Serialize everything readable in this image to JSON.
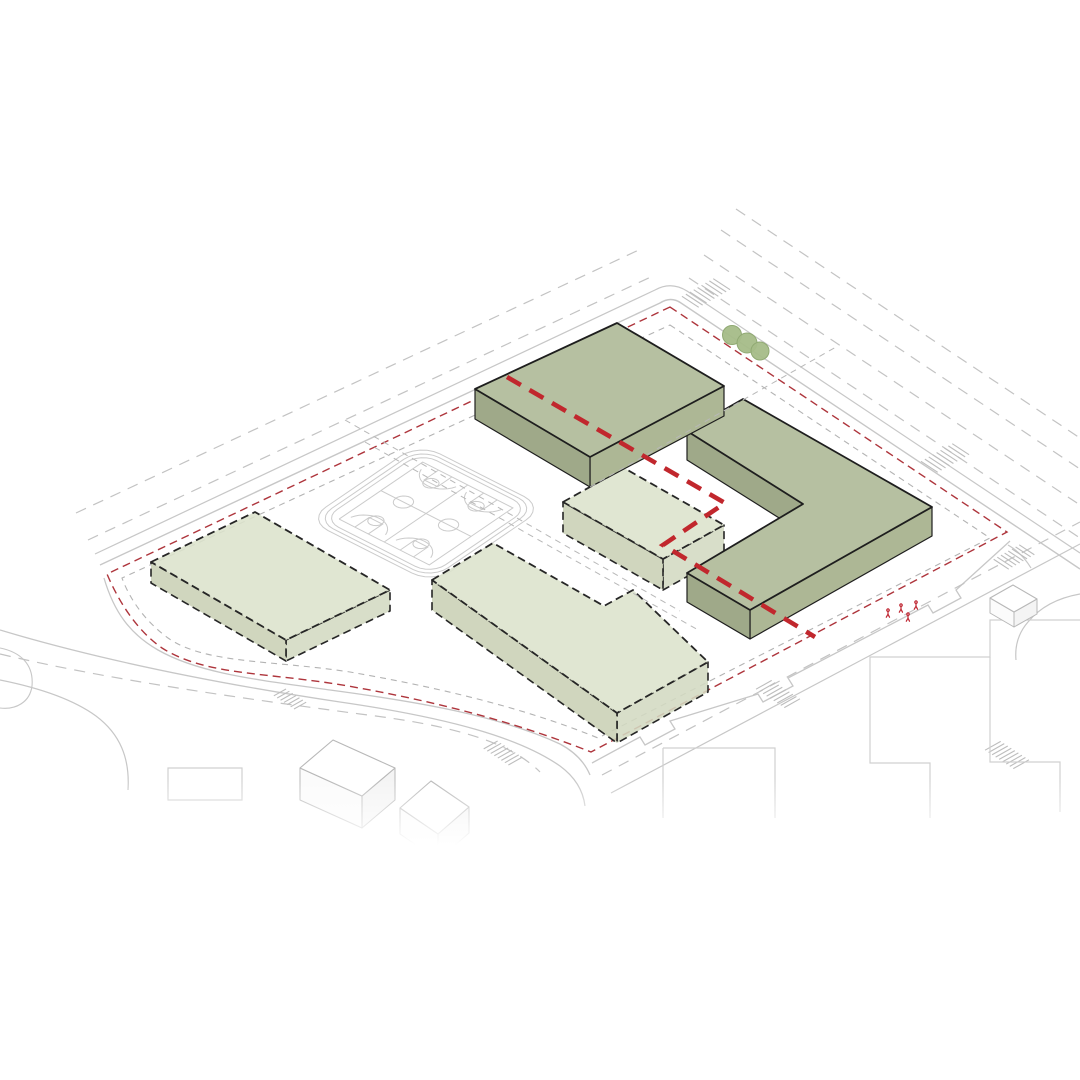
{
  "meta": {
    "description": "Axonometric architectural site massing diagram with proposed green building volumes, dashed massing slabs, running track with basketball courts, red dashed site boundary and thick red dashed pedestrian route",
    "background": "#ffffff"
  },
  "palette": {
    "dark_top": "#b6c0a1",
    "dark_sw": "#9fa989",
    "dark_se": "#adb795",
    "dark_stroke": "#1e1e1e",
    "light_top": "#dce2cc",
    "light_sw": "#c9d0b5",
    "light_se": "#d3d9c1",
    "light_stroke": "#262626",
    "curb": "#c7c7c7",
    "lane": "#c3c3c3",
    "inset": "#b3b3b3",
    "cross": "#b8b8b8",
    "red_boundary": "#ae353c",
    "red_route": "#c1272d",
    "court": "#cbcbcb",
    "crosswalk": "#bdbdbd",
    "tree_fill": "#a5bc88",
    "tree_stroke": "#90a973",
    "box_stroke": "#b8b8b8",
    "footprint": "#d0d0d0",
    "person": "#bf2430"
  },
  "roads": {
    "solid": [
      {
        "d": "M100,565 L660,303 Q671,296 681,303 L1080,569",
        "w": 1.4
      },
      {
        "d": "M95,554 L655,290 Q671,281 687,291 L1080,553",
        "w": 1.2
      },
      {
        "d": "M592,763 L640,737 l5,8 l30,-16 l-5,-8 L758,694 l5,8 l30,-16 l-5,-8 L928,605 l5,8 l28,-15 l-5,-8 L1010,541",
        "w": 1.3
      },
      {
        "d": "M611,793 L1080,544",
        "w": 1.2
      },
      {
        "d": "M104,578 C114,612 130,634 158,650 C200,674 260,680 330,690 C420,702 500,716 560,744 C575,752 585,763 590,775",
        "w": 1.3
      },
      {
        "d": "M0,630 C100,660 220,684 340,702 C450,718 520,738 560,766 C575,777 583,790 585,806",
        "w": 1.3
      },
      {
        "d": "M0,680 C40,688 74,700 96,716 C120,734 130,758 128,790",
        "w": 1.2
      },
      {
        "d": "M0,648 C20,652 34,664 32,686 C30,702 16,710 0,708",
        "w": 1.1
      },
      {
        "d": "M1008,545 Q1022,553 1031,568",
        "w": 1.2
      },
      {
        "d": "M1080,594 Q1046,600 1028,622 Q1014,638 1016,660",
        "w": 1.2
      }
    ],
    "dashed": [
      {
        "d": "M88,540 L655,275",
        "dash": "11 8"
      },
      {
        "d": "M76,513 L643,248",
        "dash": "11 8"
      },
      {
        "d": "M689,278 L1080,538",
        "dash": "11 8"
      },
      {
        "d": "M704,255 L1080,505",
        "dash": "11 8"
      },
      {
        "d": "M721,230 L1080,469",
        "dash": "11 8"
      },
      {
        "d": "M736,209 L1080,438",
        "dash": "11 8"
      },
      {
        "d": "M602,775 L1080,522",
        "dash": "11 8"
      },
      {
        "d": "M0,654 C110,680 240,698 360,714 C460,726 512,744 540,772",
        "dash": "11 8"
      }
    ],
    "crosswalks": [
      {
        "c": [
          706,
          293
        ],
        "along": [
          0.87,
          -0.49
        ],
        "tilt": [
          0.84,
          0.55
        ],
        "n": 9,
        "gap": 4.5,
        "len": 20
      },
      {
        "c": [
          945,
          458
        ],
        "along": [
          0.87,
          -0.49
        ],
        "tilt": [
          0.84,
          0.55
        ],
        "n": 9,
        "gap": 4.5,
        "len": 20
      },
      {
        "c": [
          1014,
          557
        ],
        "along": [
          0.87,
          -0.49
        ],
        "tilt": [
          0.84,
          0.55
        ],
        "n": 8,
        "gap": 4.2,
        "len": 18
      },
      {
        "c": [
          778,
          694
        ],
        "along": [
          0.84,
          0.55
        ],
        "tilt": [
          0.87,
          -0.49
        ],
        "n": 9,
        "gap": 4.2,
        "len": 18
      },
      {
        "c": [
          1007,
          755
        ],
        "along": [
          0.84,
          0.55
        ],
        "tilt": [
          0.87,
          -0.49
        ],
        "n": 9,
        "gap": 4.2,
        "len": 18
      },
      {
        "c": [
          503,
          753
        ],
        "along": [
          0.84,
          0.55
        ],
        "tilt": [
          0.87,
          -0.49
        ],
        "n": 8,
        "gap": 4.2,
        "len": 16
      },
      {
        "c": [
          290,
          699
        ],
        "along": [
          0.84,
          0.55
        ],
        "tilt": [
          0.87,
          -0.49
        ],
        "n": 7,
        "gap": 4,
        "len": 14
      }
    ]
  },
  "site": {
    "boundary_red": "M670,307 L1007,532 L591,752 C510,720 428,700 348,686 C268,672 206,676 162,648 C136,630 118,600 107,574 Z",
    "boundary_inset_gray": "M670,325 L990,538 L598,738 C520,706 430,686 350,672 C272,660 205,664 168,638 C146,622 130,600 122,578 Z",
    "crossing_dashed": [
      "M590,487 L836,347",
      "M345,420 L680,611",
      "M365,442 L700,631"
    ]
  },
  "context": {
    "footprints": [
      "M168,768 L242,768 L242,800 L168,800 Z",
      "M1080,620 L990,620 L990,657 L870,657 L870,763 L930,763 L930,818",
      "M990,657 L990,762 L1060,762 L1060,812",
      "M663,748 L775,748 L775,818",
      "M663,748 L663,818"
    ],
    "white_boxes": [
      {
        "roof": [
          [
            300,
            768
          ],
          [
            333,
            740
          ],
          [
            395,
            768
          ],
          [
            362,
            796
          ]
        ],
        "h": 32
      },
      {
        "roof": [
          [
            400,
            808
          ],
          [
            431,
            781
          ],
          [
            469,
            807
          ],
          [
            438,
            834
          ]
        ],
        "h": 26
      },
      {
        "roof": [
          [
            990,
            598
          ],
          [
            1013,
            585
          ],
          [
            1037,
            599
          ],
          [
            1014,
            612
          ]
        ],
        "h": 15
      }
    ]
  },
  "landscape": {
    "trees": [
      {
        "cx": 732,
        "cy": 335,
        "r": 9.5
      },
      {
        "cx": 747,
        "cy": 343,
        "r": 10
      },
      {
        "cx": 760,
        "cy": 351,
        "r": 9
      }
    ],
    "track": {
      "matrix": [
        110,
        -75,
        122,
        62,
        310,
        520
      ],
      "rings": [
        {
          "x": -0.01,
          "y": -0.015,
          "w": 1.02,
          "h": 1.03,
          "r": 0.17
        },
        {
          "x": 0.022,
          "y": 0.022,
          "w": 0.956,
          "h": 0.956,
          "r": 0.15
        },
        {
          "x": 0.055,
          "y": 0.055,
          "w": 0.89,
          "h": 0.89,
          "r": 0.13
        }
      ],
      "court_rect": [
        0.12,
        0.13,
        0.88,
        0.87
      ],
      "court_centers": [
        [
          0.5,
          0.315
        ],
        [
          0.5,
          0.685
        ]
      ],
      "circle_r": 0.062,
      "key_w": 0.13,
      "key_h": 0.11,
      "ft_r": 0.05,
      "arc_r": 0.15
    }
  },
  "buildings": {
    "proposed": [
      {
        "id": "building-l-block",
        "roof": [
          [
            687,
            431
          ],
          [
            743,
            399
          ],
          [
            932,
            507
          ],
          [
            750,
            610
          ],
          [
            687,
            573
          ],
          [
            803,
            504
          ]
        ],
        "h": 29
      },
      {
        "id": "building-top-slab",
        "roof": [
          [
            475,
            389
          ],
          [
            617,
            323
          ],
          [
            724,
            386
          ],
          [
            590,
            457
          ]
        ],
        "h": 30
      }
    ],
    "existing": [
      {
        "id": "slab-west",
        "roof": [
          [
            151,
            562
          ],
          [
            255,
            512
          ],
          [
            390,
            590
          ],
          [
            286,
            640
          ]
        ],
        "h": 21
      },
      {
        "id": "slab-center",
        "roof": [
          [
            563,
            502
          ],
          [
            624,
            468
          ],
          [
            724,
            525
          ],
          [
            663,
            559
          ]
        ],
        "h": 31
      },
      {
        "id": "slab-south",
        "roof": [
          [
            432,
            580
          ],
          [
            493,
            543
          ],
          [
            604,
            606
          ],
          [
            633,
            590
          ],
          [
            708,
            662
          ],
          [
            617,
            713
          ]
        ],
        "h": 30
      }
    ]
  },
  "route": {
    "points": [
      [
        507,
        377
      ],
      [
        725,
        503
      ],
      [
        663,
        545
      ],
      [
        815,
        637
      ]
    ],
    "width": 4.6,
    "dash": "16 10"
  },
  "people": {
    "positions": [
      [
        888,
        612
      ],
      [
        901,
        607
      ],
      [
        908,
        616
      ],
      [
        916,
        604
      ]
    ]
  }
}
